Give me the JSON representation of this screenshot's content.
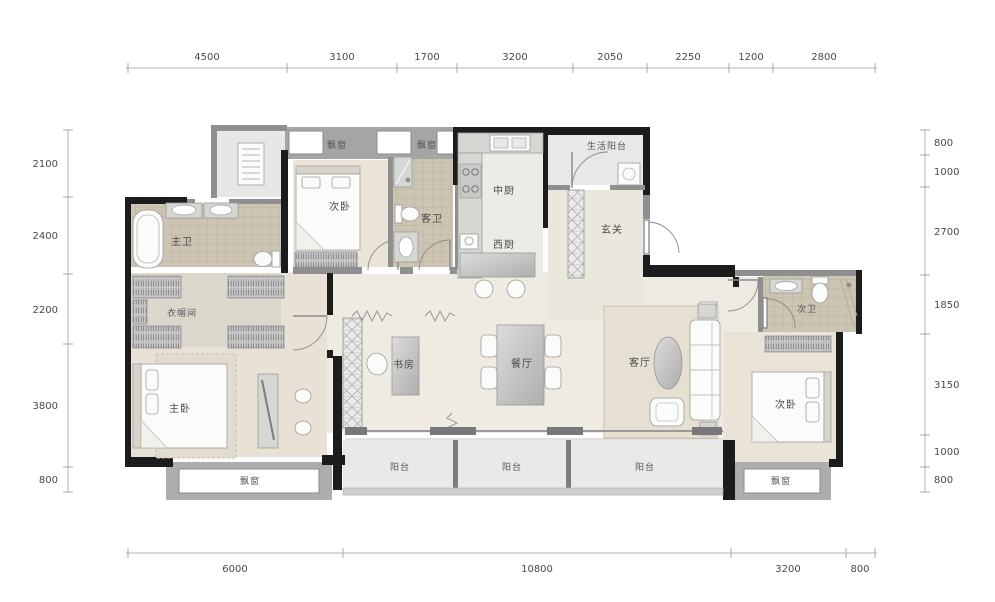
{
  "plan": {
    "rooms": {
      "master_bath": "主卫",
      "cloakroom": "衣帽间",
      "master_bedroom": "主卧",
      "bedroom_top": "次卧",
      "guest_bath": "客卫",
      "kitchen_cn": "中厨",
      "kitchen_west": "西厨",
      "service_balcony": "生活阳台",
      "foyer": "玄关",
      "study": "书房",
      "dining_room": "餐厅",
      "living_room": "客厅",
      "second_bath": "次卫",
      "bedroom_right": "次卧",
      "balcony_1": "阳台",
      "balcony_2": "阳台",
      "balcony_3": "阳台",
      "bay_window_top_1": "飘窗",
      "bay_window_top_2": "飘窗",
      "bay_window_left": "飘窗",
      "bay_window_right": "飘窗"
    },
    "dimensions": {
      "top": [
        "4500",
        "3100",
        "1700",
        "3200",
        "2050",
        "2250",
        "1200",
        "2800"
      ],
      "left": [
        "2100",
        "2400",
        "2200",
        "3800",
        "800"
      ],
      "right": [
        "800",
        "1000",
        "2700",
        "1850",
        "3150",
        "1000",
        "800"
      ],
      "bottom": [
        "6000",
        "10800",
        "3200",
        "800"
      ]
    },
    "colors": {
      "wall": "#1c1c1c",
      "gray_wall": "#8f8f8f",
      "tile": "#cfc7b5",
      "warm_floor": "#e9e3d7",
      "light_floor": "#f0ebe2",
      "balcony_floor": "#e9e9e7",
      "dim_text": "#4a4a4a"
    }
  }
}
